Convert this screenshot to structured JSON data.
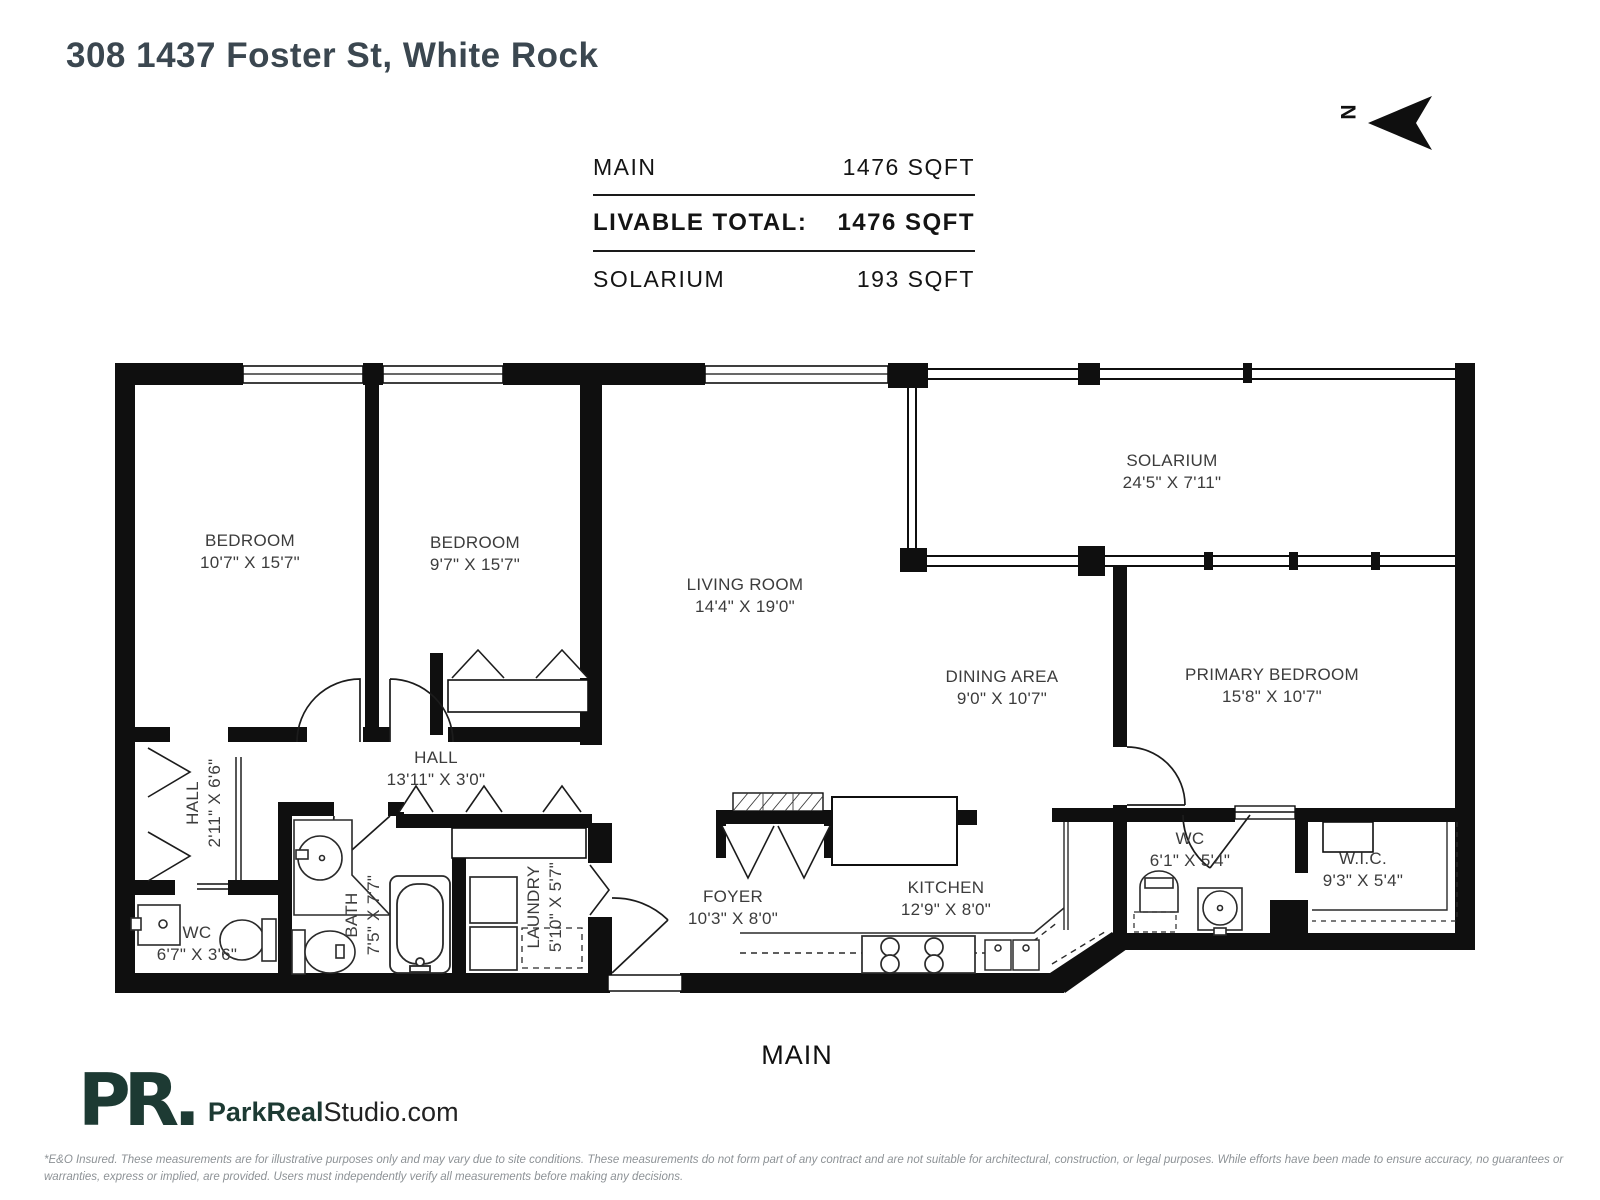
{
  "header": {
    "title": "308 1437 Foster St, White Rock",
    "north_label": "N"
  },
  "area_table": {
    "rows": [
      {
        "label": "MAIN",
        "value": "1476 SQFT"
      },
      {
        "label": "LIVABLE TOTAL:",
        "value": "1476 SQFT"
      },
      {
        "label": "SOLARIUM",
        "value": "193 SQFT"
      }
    ]
  },
  "rooms": {
    "bedroom1": {
      "name": "BEDROOM",
      "dims": "10'7\" X 15'7\""
    },
    "bedroom2": {
      "name": "BEDROOM",
      "dims": "9'7\" X 15'7\""
    },
    "living": {
      "name": "LIVING ROOM",
      "dims": "14'4\" X 19'0\""
    },
    "solarium": {
      "name": "SOLARIUM",
      "dims": "24'5\" X 7'11\""
    },
    "dining": {
      "name": "DINING AREA",
      "dims": "9'0\" X 10'7\""
    },
    "primary": {
      "name": "PRIMARY BEDROOM",
      "dims": "15'8\" X 10'7\""
    },
    "hall_v": {
      "name": "HALL",
      "dims": "2'11\" X 6'6\""
    },
    "hall_h": {
      "name": "HALL",
      "dims": "13'11\" X 3'0\""
    },
    "wc_left": {
      "name": "WC",
      "dims": "6'7\" X 3'6\""
    },
    "bath": {
      "name": "BATH",
      "dims": "7'5\" X 7'7\""
    },
    "laundry": {
      "name": "LAUNDRY",
      "dims": "5'10\" X 5'7\""
    },
    "foyer": {
      "name": "FOYER",
      "dims": "10'3\" X 8'0\""
    },
    "kitchen": {
      "name": "KITCHEN",
      "dims": "12'9\" X 8'0\""
    },
    "wc_right": {
      "name": "WC",
      "dims": "6'1\" X 5'4\""
    },
    "wic": {
      "name": "W.I.C.",
      "dims": "9'3\" X 5'4\""
    }
  },
  "floor_label": "MAIN",
  "footer": {
    "logo_mark": "PR.",
    "logo_bold": "ParkReal",
    "logo_regular": "Studio.com",
    "disclaimer": "*E&O Insured. These measurements are for illustrative purposes only and may vary due to site conditions. These measurements do not form part of any contract and are not suitable for architectural, construction, or legal purposes. While efforts have been made to ensure accuracy, no guarantees or warranties, express or implied, are provided. Users must independently verify all measurements before making any decisions."
  },
  "colors": {
    "wall": "#0f0f0f",
    "logo": "#1d3a33",
    "title": "#3b4750",
    "label": "#3c3c3c",
    "disclaimer": "#8d9296"
  }
}
